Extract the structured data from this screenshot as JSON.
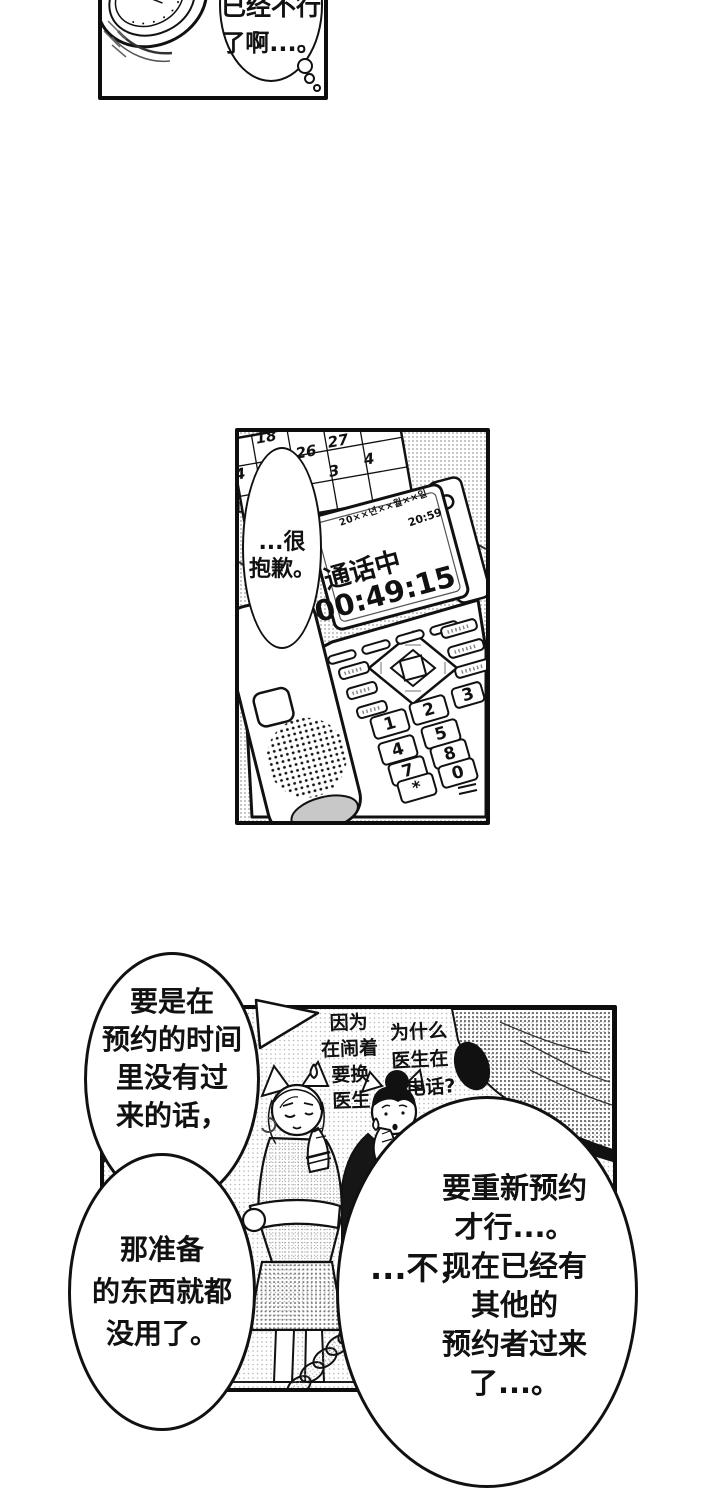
{
  "page": {
    "bg": "#ffffff",
    "ink": "#111111"
  },
  "panel_top": {
    "thought_bubble": {
      "clipped_line": "已经不行",
      "line": "了啊...。"
    }
  },
  "panel_middle": {
    "calendar": {
      "numbers": [
        "18",
        "26",
        "27",
        "3",
        "4"
      ],
      "edge_numbers": [
        "4",
        "1"
      ]
    },
    "phone_display": {
      "date": "20××년××월××일",
      "clock_time": "20:59",
      "status": "通话中",
      "call_duration": "00:49:15"
    },
    "speech_bubble": {
      "lines": [
        "...很",
        "抱歉。"
      ]
    },
    "keypad_keys": [
      "1",
      "2",
      "3",
      "4",
      "5",
      "7",
      "8",
      "0",
      "*"
    ]
  },
  "panel_bottom": {
    "caption_left": {
      "lines": [
        "因为",
        "在闹着",
        "要换",
        "医生"
      ]
    },
    "caption_right": {
      "lines": [
        "为什么",
        "医生在",
        "打电话?"
      ]
    },
    "speech_bubble_top_left": {
      "lines": [
        "要是在",
        "预约的时间",
        "里没有过",
        "来的话，"
      ]
    },
    "speech_bubble_bottom_left": {
      "lines": [
        "那准备",
        "的东西就都",
        "没用了。"
      ]
    },
    "speech_bubble_right": {
      "aside": "...不，",
      "lines": [
        "要重新预约",
        "才行...。",
        "现在已经有",
        "其他的",
        "预约者过来",
        "了...。"
      ]
    }
  }
}
